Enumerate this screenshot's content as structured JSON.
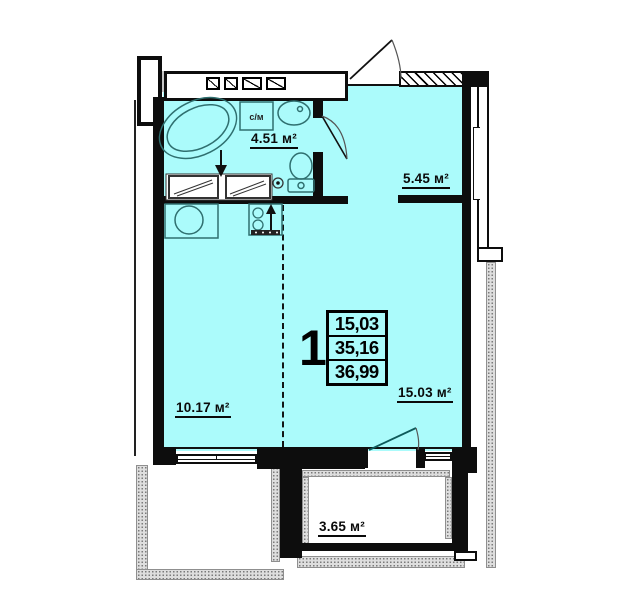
{
  "floor_plan": {
    "room_labels": {
      "bathroom": "4.51 м²",
      "hallway": "5.45 м²",
      "living_room": "15.03 м²",
      "kitchen": "10.17 м²",
      "balcony": "3.65 м²"
    },
    "fixture_labels": {
      "washing_machine": "с/м"
    },
    "info_stamp": {
      "rooms_count": "1",
      "values": [
        "15,03",
        "35,16",
        "36,99"
      ]
    },
    "colors": {
      "room_fill": "#abfbfb",
      "wall": "#0d0d0d",
      "balcony_texture": "#dedede"
    }
  }
}
